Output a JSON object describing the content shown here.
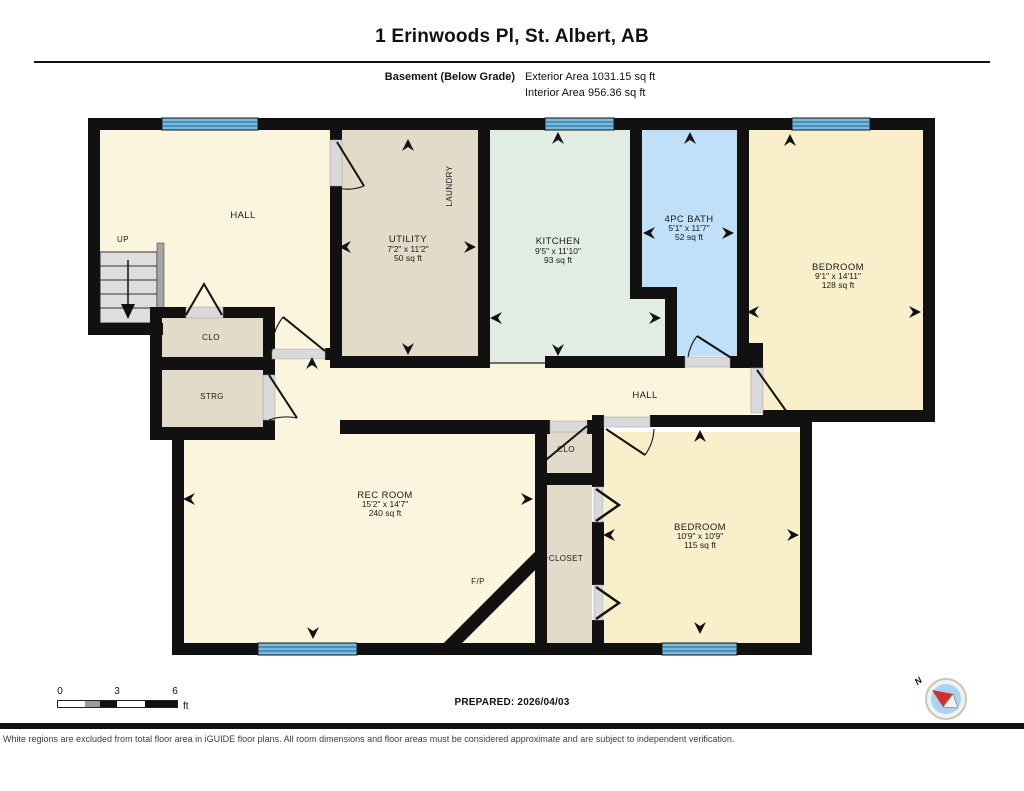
{
  "header": {
    "title": "1 Erinwoods Pl, St. Albert, AB",
    "floor_label": "Basement (Below Grade)",
    "exterior_area": "Exterior Area 1031.15 sq ft",
    "interior_area": "Interior Area 956.36 sq ft"
  },
  "rooms": {
    "hall_top": {
      "name": "HALL"
    },
    "up_label": "UP",
    "laundry_label": "LAUNDRY",
    "utility": {
      "name": "UTILITY",
      "dims": "7'2\" x 11'2\"",
      "area": "50 sq ft"
    },
    "kitchen": {
      "name": "KITCHEN",
      "dims": "9'5\" x 11'10\"",
      "area": "93 sq ft"
    },
    "bath": {
      "name": "4PC BATH",
      "dims": "5'1\" x 11'7\"",
      "area": "52 sq ft"
    },
    "bedroom_tr": {
      "name": "BEDROOM",
      "dims": "9'1\" x 14'11\"",
      "area": "128 sq ft"
    },
    "hall_mid": {
      "name": "HALL"
    },
    "clo_left": "CLO",
    "strg": "STRG",
    "clo_mid": "CLO",
    "closet": "CLOSET",
    "fp": "F/P",
    "rec": {
      "name": "REC ROOM",
      "dims": "15'2\" x 14'7\"",
      "area": "240 sq ft"
    },
    "bedroom_b": {
      "name": "BEDROOM",
      "dims": "10'9\" x 10'9\"",
      "area": "115 sq ft"
    }
  },
  "scale": {
    "t0": "0",
    "t3": "3",
    "t6": "6",
    "unit": "ft"
  },
  "prepared": "PREPARED: 2026/04/03",
  "compass_n": "N",
  "disclaimer": "White regions are excluded from total floor area in iGUIDE floor plans. All room dimensions and floor areas must be considered approximate and are subject to independent verification.",
  "colors": {
    "wall": "#111111",
    "cream": "#FCF5DE",
    "bedroom_cream": "#FAEFCB",
    "tan": "#E3DBC9",
    "mint": "#E1ECE2",
    "bath_blue": "#BFE0F8",
    "window_blue": "#79B9E0",
    "window_stripe": "#1D6290",
    "sill_grey": "#D9D9D9",
    "stair_grey": "#DEDEDE",
    "compass_red": "#D32F2F"
  }
}
